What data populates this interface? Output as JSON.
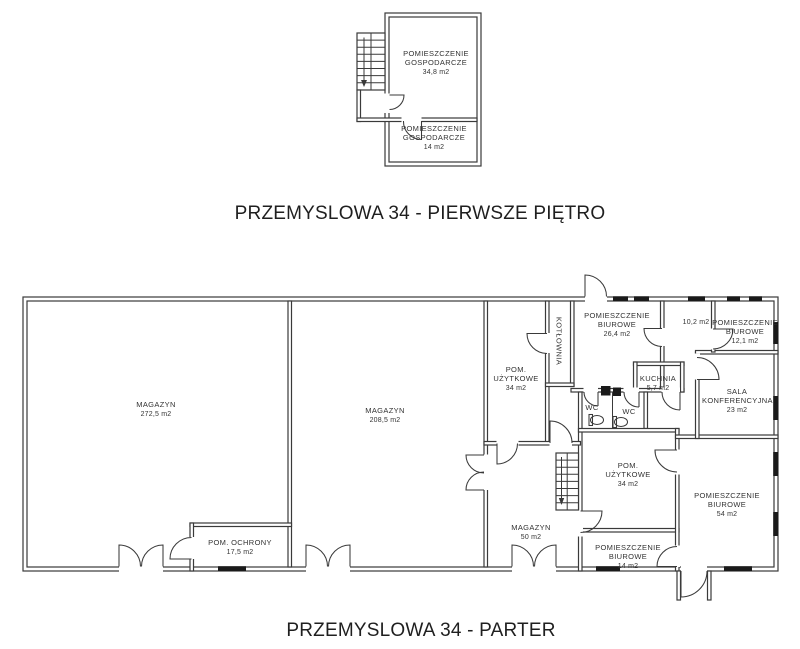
{
  "pietro": {
    "title": "PRZEMYSLOWA 34 - PIERWSZE PIĘTRO",
    "rooms": [
      {
        "name": "POMIESZCZENIE GOSPODARCZE",
        "area": "34,8 m2"
      },
      {
        "name": "POMIESZCZENIE GOSPODARCZE",
        "area": "14 m2"
      }
    ]
  },
  "parter": {
    "title": "PRZEMYSLOWA 34 - PARTER",
    "rooms": [
      {
        "name": "MAGAZYN",
        "area": "272,5 m2"
      },
      {
        "name": "MAGAZYN",
        "area": "208,5 m2"
      },
      {
        "name": "POM. OCHRONY",
        "area": "17,5 m2"
      },
      {
        "name": "POM. UŻYTKOWE",
        "area": "34 m2"
      },
      {
        "name": "KOTŁOWNIA",
        "area": ""
      },
      {
        "name": "POMIESZCZENIE BIUROWE",
        "area": "26,4 m2"
      },
      {
        "name": "",
        "area": "10,2 m2"
      },
      {
        "name": "POMIESZCZENIE BIUROWE",
        "area": "12,1 m2"
      },
      {
        "name": "KUCHNIA",
        "area": "5,7 m2"
      },
      {
        "name": "SALA KONFERENCYJNA",
        "area": "23 m2"
      },
      {
        "name": "WC",
        "area": ""
      },
      {
        "name": "WC",
        "area": ""
      },
      {
        "name": "POM. UŻYTKOWE",
        "area": "34 m2"
      },
      {
        "name": "MAGAZYN",
        "area": "50 m2"
      },
      {
        "name": "POMIESZCZENIE BIUROWE",
        "area": "14 m2"
      },
      {
        "name": "POMIESZCZENIE BIUROWE",
        "area": "54 m2"
      }
    ]
  }
}
